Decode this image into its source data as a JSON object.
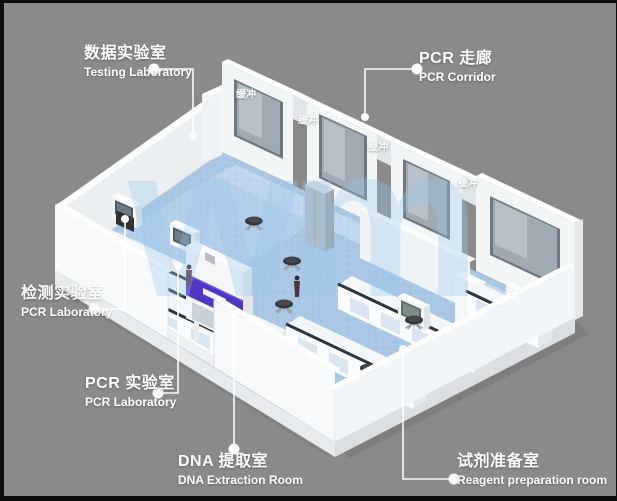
{
  "scene": {
    "background_color": "#8a8a8a",
    "frame_color": "#0d0d0d",
    "floor_color": "#a9c7e4",
    "wall_color": "#f4f6f7",
    "glass_color": "#9aa4ac",
    "accent_purple": "#5136c8"
  },
  "watermark": {
    "text": "wm"
  },
  "callouts": [
    {
      "id": "testing-laboratory",
      "zh": "数据实验室",
      "en": "Testing Laboratory"
    },
    {
      "id": "pcr-corridor",
      "zh": "PCR 走廊",
      "en": "PCR Corridor"
    },
    {
      "id": "inspection-laboratory",
      "zh": "检测实验室",
      "en": "PCR Laboratory"
    },
    {
      "id": "pcr-laboratory",
      "zh": "PCR 实验室",
      "en": "PCR Laboratory"
    },
    {
      "id": "dna-extraction-room",
      "zh": "DNA 提取室",
      "en": "DNA Extraction Room"
    },
    {
      "id": "reagent-preparation",
      "zh": "试剂准备室",
      "en": "Reagent preparation room"
    }
  ],
  "buffer_rooms": [
    {
      "label": "缓冲"
    },
    {
      "label": "缓冲"
    },
    {
      "label": "缓冲"
    },
    {
      "label": "缓冲"
    }
  ]
}
